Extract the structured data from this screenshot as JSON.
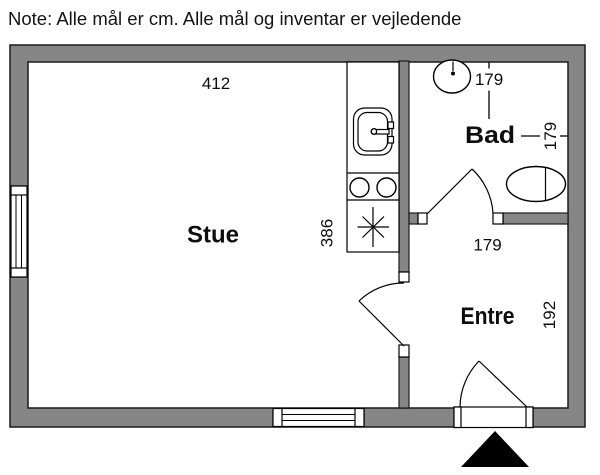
{
  "note": {
    "text": "Note: Alle mål er cm. Alle mål og inventar er vejledende"
  },
  "rooms": {
    "stue": {
      "label": "Stue",
      "width_cm": "412",
      "depth_cm": "386"
    },
    "bad": {
      "label": "Bad",
      "width_cm": "179",
      "depth_cm": "179"
    },
    "entre": {
      "label": "Entre",
      "width_cm": "179",
      "depth_cm": "192"
    }
  },
  "fixtures": {
    "kitchen_sink": "kitchen-sink",
    "cooktop": "cooktop-two-burners",
    "stove_symbol": "stove-asterisk-symbol",
    "bath_sink": "washbasin",
    "toilet": "toilet",
    "windows": [
      "left-wall-window",
      "bottom-wall-window"
    ],
    "doors": [
      "bad-door",
      "stue-entre-door",
      "entrance-door"
    ],
    "entrance_marker": "entrance-arrow"
  },
  "colors": {
    "wall": "#868686",
    "outline": "#1a1a1a",
    "background": "#ffffff",
    "arrow": "#000000"
  }
}
